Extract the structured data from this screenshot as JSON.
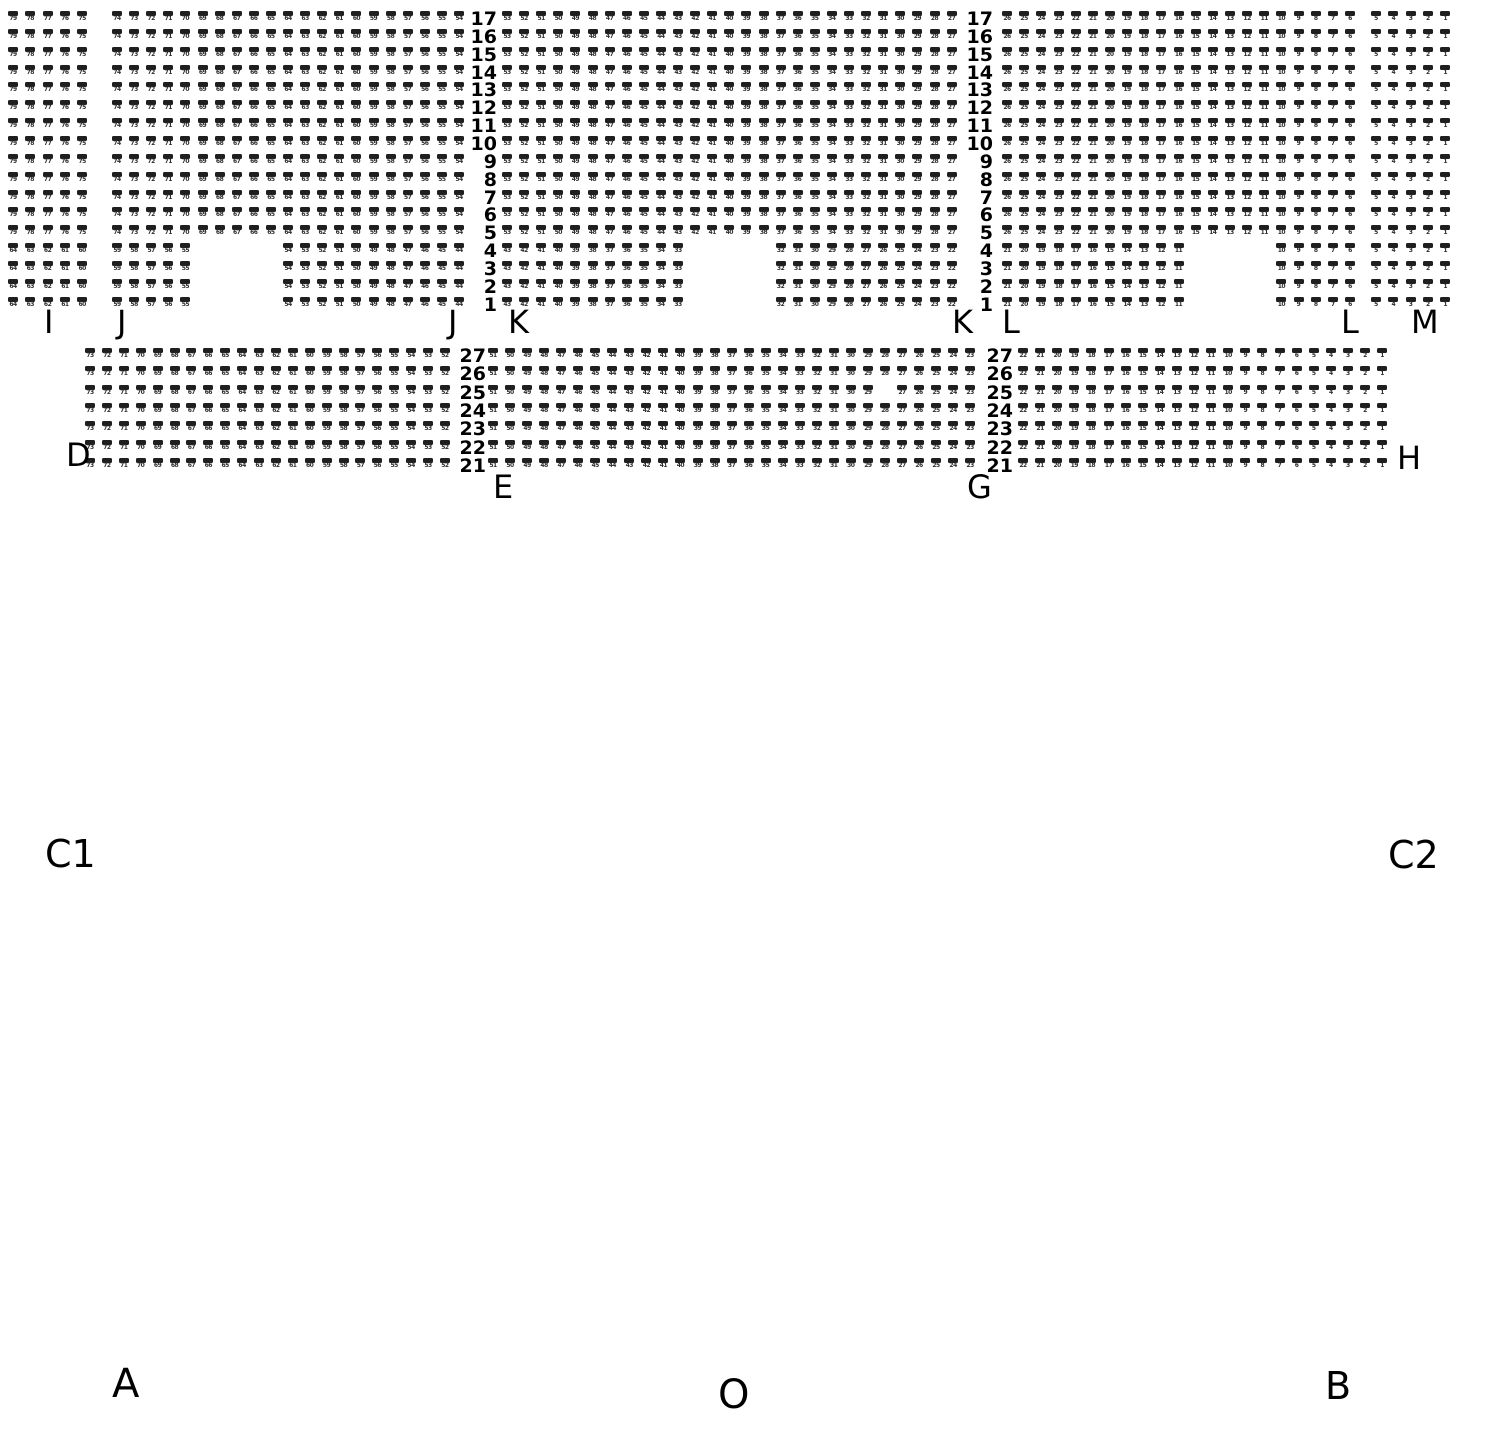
{
  "section_labels": {
    "I": "I",
    "J": "J",
    "K": "K",
    "L": "L",
    "M": "M",
    "D": "D",
    "E": "E",
    "G": "G",
    "H": "H",
    "C1": "C1",
    "C2": "C2",
    "A": "A",
    "B": "B",
    "O": "O"
  },
  "seat_map": {
    "colors": {
      "seat_bar": "#1f1f1f",
      "seat_number": "#2e2e2e",
      "row_number": "#000000",
      "label": "#000000"
    },
    "upper_tier": {
      "y0": 11,
      "row_pitch": 17.85,
      "row_top": 17,
      "row_bottom": 1,
      "full_rows_from": 5,
      "row_number_columns": [
        {
          "right_x": 497
        },
        {
          "right_x": 993
        }
      ],
      "blocks": [
        {
          "section": "I",
          "x0": 8,
          "pitch": 17.3,
          "cols": 5,
          "full_first_seat": 79,
          "short_groups": [
            {
              "col": 1,
              "first_seat": 64,
              "count": 5
            }
          ]
        },
        {
          "section": "J",
          "x0": 112,
          "pitch": 17.1,
          "cols": 21,
          "full_first_seat": 74,
          "short_groups": [
            {
              "col": 1,
              "first_seat": 59,
              "count": 5
            },
            {
              "col": 11,
              "first_seat": 54,
              "count": 11
            }
          ]
        },
        {
          "section": "K",
          "x0": 502,
          "pitch": 17.1,
          "cols": 27,
          "full_first_seat": 53,
          "short_groups": [
            {
              "col": 1,
              "first_seat": 43,
              "count": 11
            },
            {
              "col": 17,
              "first_seat": 32,
              "count": 11
            }
          ]
        },
        {
          "section": "L",
          "x0": 1002,
          "pitch": 17.15,
          "cols": 21,
          "full_first_seat": 26,
          "short_groups": [
            {
              "col": 1,
              "first_seat": 21,
              "count": 11
            },
            {
              "col": 17,
              "first_seat": 10,
              "count": 5
            }
          ]
        },
        {
          "section": "M",
          "x0": 1371,
          "pitch": 17.3,
          "cols": 5,
          "full_first_seat": 5,
          "short_groups": [
            {
              "col": 1,
              "first_seat": 5,
              "count": 5
            }
          ]
        }
      ]
    },
    "lower_tier": {
      "y0": 348,
      "row_pitch": 18.3,
      "row_top": 27,
      "row_bottom": 21,
      "row_number_columns": [
        {
          "right_x": 486
        },
        {
          "right_x": 1013
        }
      ],
      "blocks": [
        {
          "section": "D",
          "x0": 85,
          "pitch": 16.9,
          "cols": 22,
          "first_seat": 73,
          "missing": []
        },
        {
          "section": "E-G",
          "x0": 488,
          "pitch": 17.04,
          "cols": 29,
          "first_seat": 51,
          "missing": [
            {
              "row": 25,
              "seat": 28
            }
          ]
        },
        {
          "section": "H",
          "x0": 1018,
          "pitch": 17.1,
          "cols": 22,
          "first_seat": 22,
          "missing": []
        }
      ]
    }
  }
}
